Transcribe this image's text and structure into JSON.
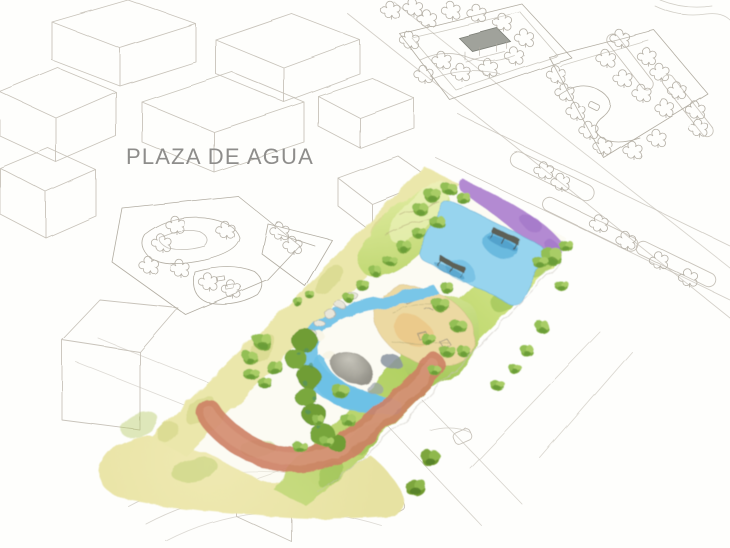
{
  "title": "PLAZA DE AGUA",
  "scene": {
    "type": "architectural watercolor masterplan, axonometric aerial view",
    "description": "Pencil-sketched city blocks and streets with the central linear water plaza hand-painted in watercolor",
    "features": {
      "lawn_northwest": "pale yellow lawn strip along north-west edge",
      "lawn_southeast": "yellow-green lawn strip along south-east edge with street tree row",
      "purple_garden": "purple planting band at north-east corner",
      "upper_pool": "rectangular blue water pool with two grey deck benches",
      "green_mounds": "planted mounds with tree clusters",
      "sand_play_area": "oval sand play area with sketched equipment",
      "stream": "winding blue stream with islands, pebbles and boulders",
      "red_path": "curved terracotta path at the south end",
      "tall_tree_cluster": "large dark green tree cluster with dotted texture",
      "sketch_context": "unpainted pencil context: box buildings, roads with medians, two sketched parks with pavilion and S-path, circular plaza arcs"
    }
  },
  "palette": {
    "paper": "#fefefc",
    "pencil": "#c8c3ba",
    "pencil_dark": "#b2ada2",
    "title_text": "#8e8d8b",
    "lawn_yellow": "#ebe7ab",
    "lawn_green": "#b1d162",
    "mound_green": "#c9dd80",
    "tree_green": "#7fae42",
    "tree_dark": "#6f9a2f",
    "water_blue": "#57b9e2",
    "water_deep": "#3f9fd0",
    "purple": "#b38ad2",
    "sand": "#ecd9a2",
    "sand_orange": "#e9bc74",
    "path_red": "#cd8064",
    "rock_gray": "#a09d94",
    "bench_gray": "#5d6157",
    "pavilion_gray": "#8f928a"
  }
}
